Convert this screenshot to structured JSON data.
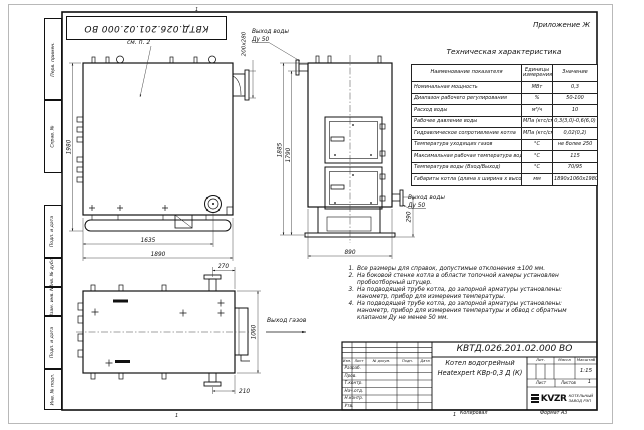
{
  "page": {
    "appendix": "Приложение Ж",
    "top_stamp": "КВТД.026.201.02.000 ВО",
    "copy_label": "Копировал",
    "format_label": "Формат А3",
    "zone_top": "1",
    "zone_bottom_left": "1",
    "zone_bottom_mid": "1"
  },
  "margin_labels": {
    "perv_primen": "Перв. примен.",
    "sprav_no": "Справ. №",
    "podp_data_1": "Подп. и дата",
    "inv_dubl": "Инв. № дубл.",
    "vzam_inv": "Взам. инв. №",
    "podp_data_2": "Подп. и дата",
    "inv_podl": "Инв. № подл."
  },
  "spec_table": {
    "title": "Техническая характеристика",
    "col_name": "Наименование показателя",
    "col_units": "Единицы измерения",
    "col_value": "Значение",
    "rows": [
      [
        "Номинальная мощность",
        "МВт",
        "0,3"
      ],
      [
        "Диапазон рабочего регулирования",
        "%",
        "50-100"
      ],
      [
        "Расход воды",
        "м³/ч",
        "10"
      ],
      [
        "Рабочее давление воды",
        "МПа (кгс/см²)",
        "0,3(3,0)-0,6(6,0)"
      ],
      [
        "Гидравлическое сопротивление котла",
        "МПа (кгс/см²)",
        "0,02(0,2)"
      ],
      [
        "Температура уходящих газов",
        "°С",
        "не более 250"
      ],
      [
        "Максимальная рабочая температура воды",
        "°С",
        "115"
      ],
      [
        "Температура воды (Вход/Выход)",
        "°С",
        "70/95"
      ],
      [
        "Габариты котла (длина х ширина х высота)",
        "мм",
        "1890х1060х1980"
      ]
    ]
  },
  "notes": [
    {
      "n": "1.",
      "t": "Все размеры для справок, допустимые отклонения ±100 мм."
    },
    {
      "n": "2.",
      "t": "На боковой стенке котла в области топочной камеры установлен пробоотборный штуцер."
    },
    {
      "n": "3.",
      "t": "На подводящей трубе котла, до запорной арматуры установлены: манометр, прибор для измерения температуры."
    },
    {
      "n": "4.",
      "t": "На подводящей трубе котла, до запорной арматуры установлены: манометр, прибор для измерения температуры и обвод с обратным клапаном Ду не менее 50 мм."
    }
  ],
  "title_block": {
    "doc_number": "КВТД.026.201.02.000 ВО",
    "name_line1": "Котел водогрейный",
    "name_line2": "Heatexpert КВр-0,3 Д (К)",
    "cols": [
      "Изм.",
      "Лист",
      "№ докум.",
      "Подп.",
      "Дата"
    ],
    "roles": [
      "Разраб.",
      "Пров.",
      "Т.контр.",
      "Нач.отд.",
      "Н.контр.",
      "Утв."
    ],
    "lit_label": "Лит.",
    "mass_label": "Масса",
    "scale_label": "Масштаб",
    "scale_value": "1:15",
    "sheet_label": "Лист",
    "sheets_label": "Листов",
    "sheets_value": "1",
    "logo_text": "KVZR",
    "company_line1": "КОТЕЛЬНЫЙ",
    "company_line2": "ЗАВОД РЭП"
  },
  "dims": {
    "side_height": "1980",
    "side_len_inner": "1635",
    "side_len_total": "1890",
    "flue_section": "200х280",
    "front_h_outer": "1885",
    "front_h_inner": "1790",
    "front_width": "890",
    "outlet_height": "290",
    "plan_flue_offset": "270",
    "plan_width": "1060",
    "plan_pipe_offset": "210"
  },
  "labels": {
    "see_note": "см. п. 2",
    "water_top1": "Выход воды",
    "water_top2": "Ду 50",
    "water_right1": "Выход воды",
    "water_right2": "Ду 50",
    "gas_out": "Выход газов"
  }
}
